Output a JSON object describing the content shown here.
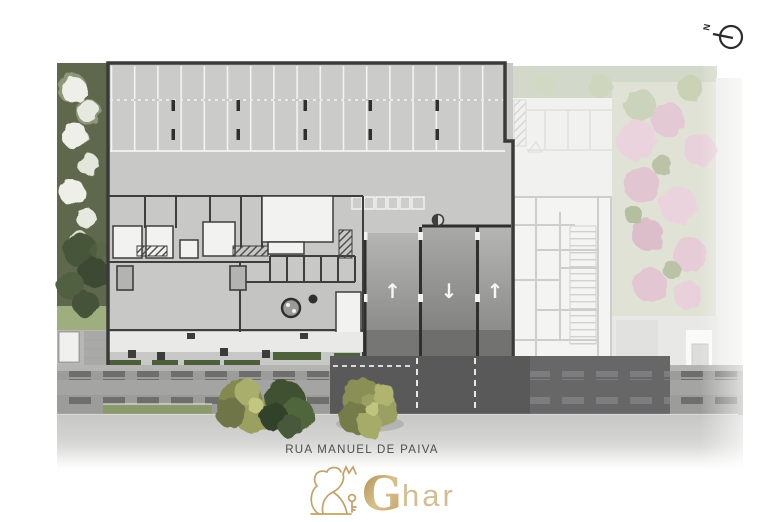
{
  "street": {
    "label": "RUA MANUEL DE PAIVA"
  },
  "compass": {
    "label": "N"
  },
  "logo": {
    "initial": "G",
    "rest": "har",
    "gold": "#c0a067",
    "gold_light": "#d3bd92"
  },
  "plan": {
    "lanes": [
      {
        "direction": "up",
        "glyph": "↑"
      },
      {
        "direction": "down",
        "glyph": "↓"
      },
      {
        "direction": "up",
        "glyph": "↑"
      }
    ],
    "parking": {
      "rows": 2,
      "stalls_per_row": 17
    }
  },
  "icons": {
    "north_arrow": "compass circle with needle pointing left",
    "lane_up": "↑",
    "lane_down": "↓"
  },
  "colors": {
    "background": "#ffffff",
    "concrete": "#c8c8c6",
    "building_outline": "#3a3a3a",
    "interior_wall": "#3e3e3e",
    "white_room": "#f2f2f0",
    "asphalt": "#59595a",
    "sidewalk": "#c6c7c5",
    "paver_dash": "#6e6e6c",
    "garden_dark_green": "#46543a",
    "flower_tree_white": "#edefe8",
    "street_tree_olive": "#8a8f55",
    "hedge_green": "#4c5e3a",
    "neighbor_faded": "#f2f2f0",
    "pink_tree": "#e5cad5",
    "pale_green": "#ccd3c1",
    "brand_gold": "#c0a067",
    "street_text": "#4e4f53"
  }
}
